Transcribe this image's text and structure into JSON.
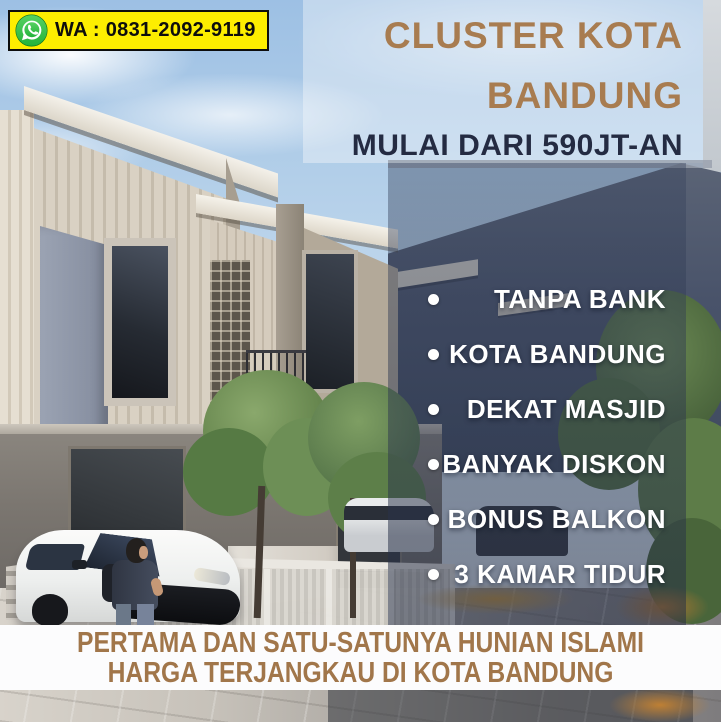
{
  "contact": {
    "icon": "whatsapp-icon",
    "label": "WA : 0831-2092-9119"
  },
  "header": {
    "title_line1": "CLUSTER KOTA",
    "title_line2": "BANDUNG",
    "subtitle": "MULAI DARI 590JT-AN"
  },
  "features": [
    "TANPA BANK",
    "KOTA BANDUNG",
    "DEKAT MASJID",
    "BANYAK DISKON",
    "BONUS BALKON",
    "3 KAMAR TIDUR"
  ],
  "footer": {
    "line1": "PERTAMA DAN SATU-SATUNYA HUNIAN ISLAMI",
    "line2": "HARGA TERJANGKAU DI KOTA BANDUNG"
  },
  "colors": {
    "accent_brown": "#a87c50",
    "navy": "#242b42",
    "badge_yellow": "#fdee00",
    "badge_border": "#0d0d0d",
    "whatsapp_green": "#25b23e",
    "feature_text": "#ffffff",
    "banner_background": "#fcfcfd",
    "banner_text": "#a1764a",
    "overlay": "#2a334c"
  }
}
